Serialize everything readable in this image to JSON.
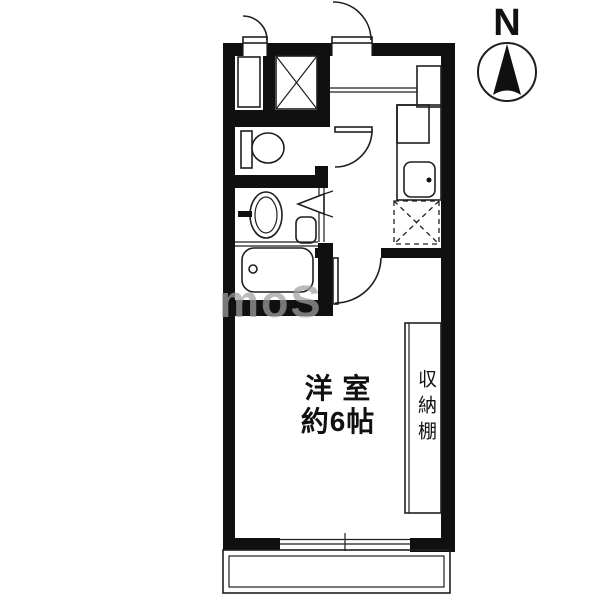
{
  "compass": {
    "label": "N"
  },
  "rooms": {
    "main_room": {
      "line1": "洋 室",
      "line2": "約6帖"
    },
    "closet": {
      "label": "収納棚"
    }
  },
  "watermark": {
    "text": "moS"
  },
  "colors": {
    "wall": "#101010",
    "line": "#1f1f1f",
    "watermark": "#a0a0a0"
  }
}
